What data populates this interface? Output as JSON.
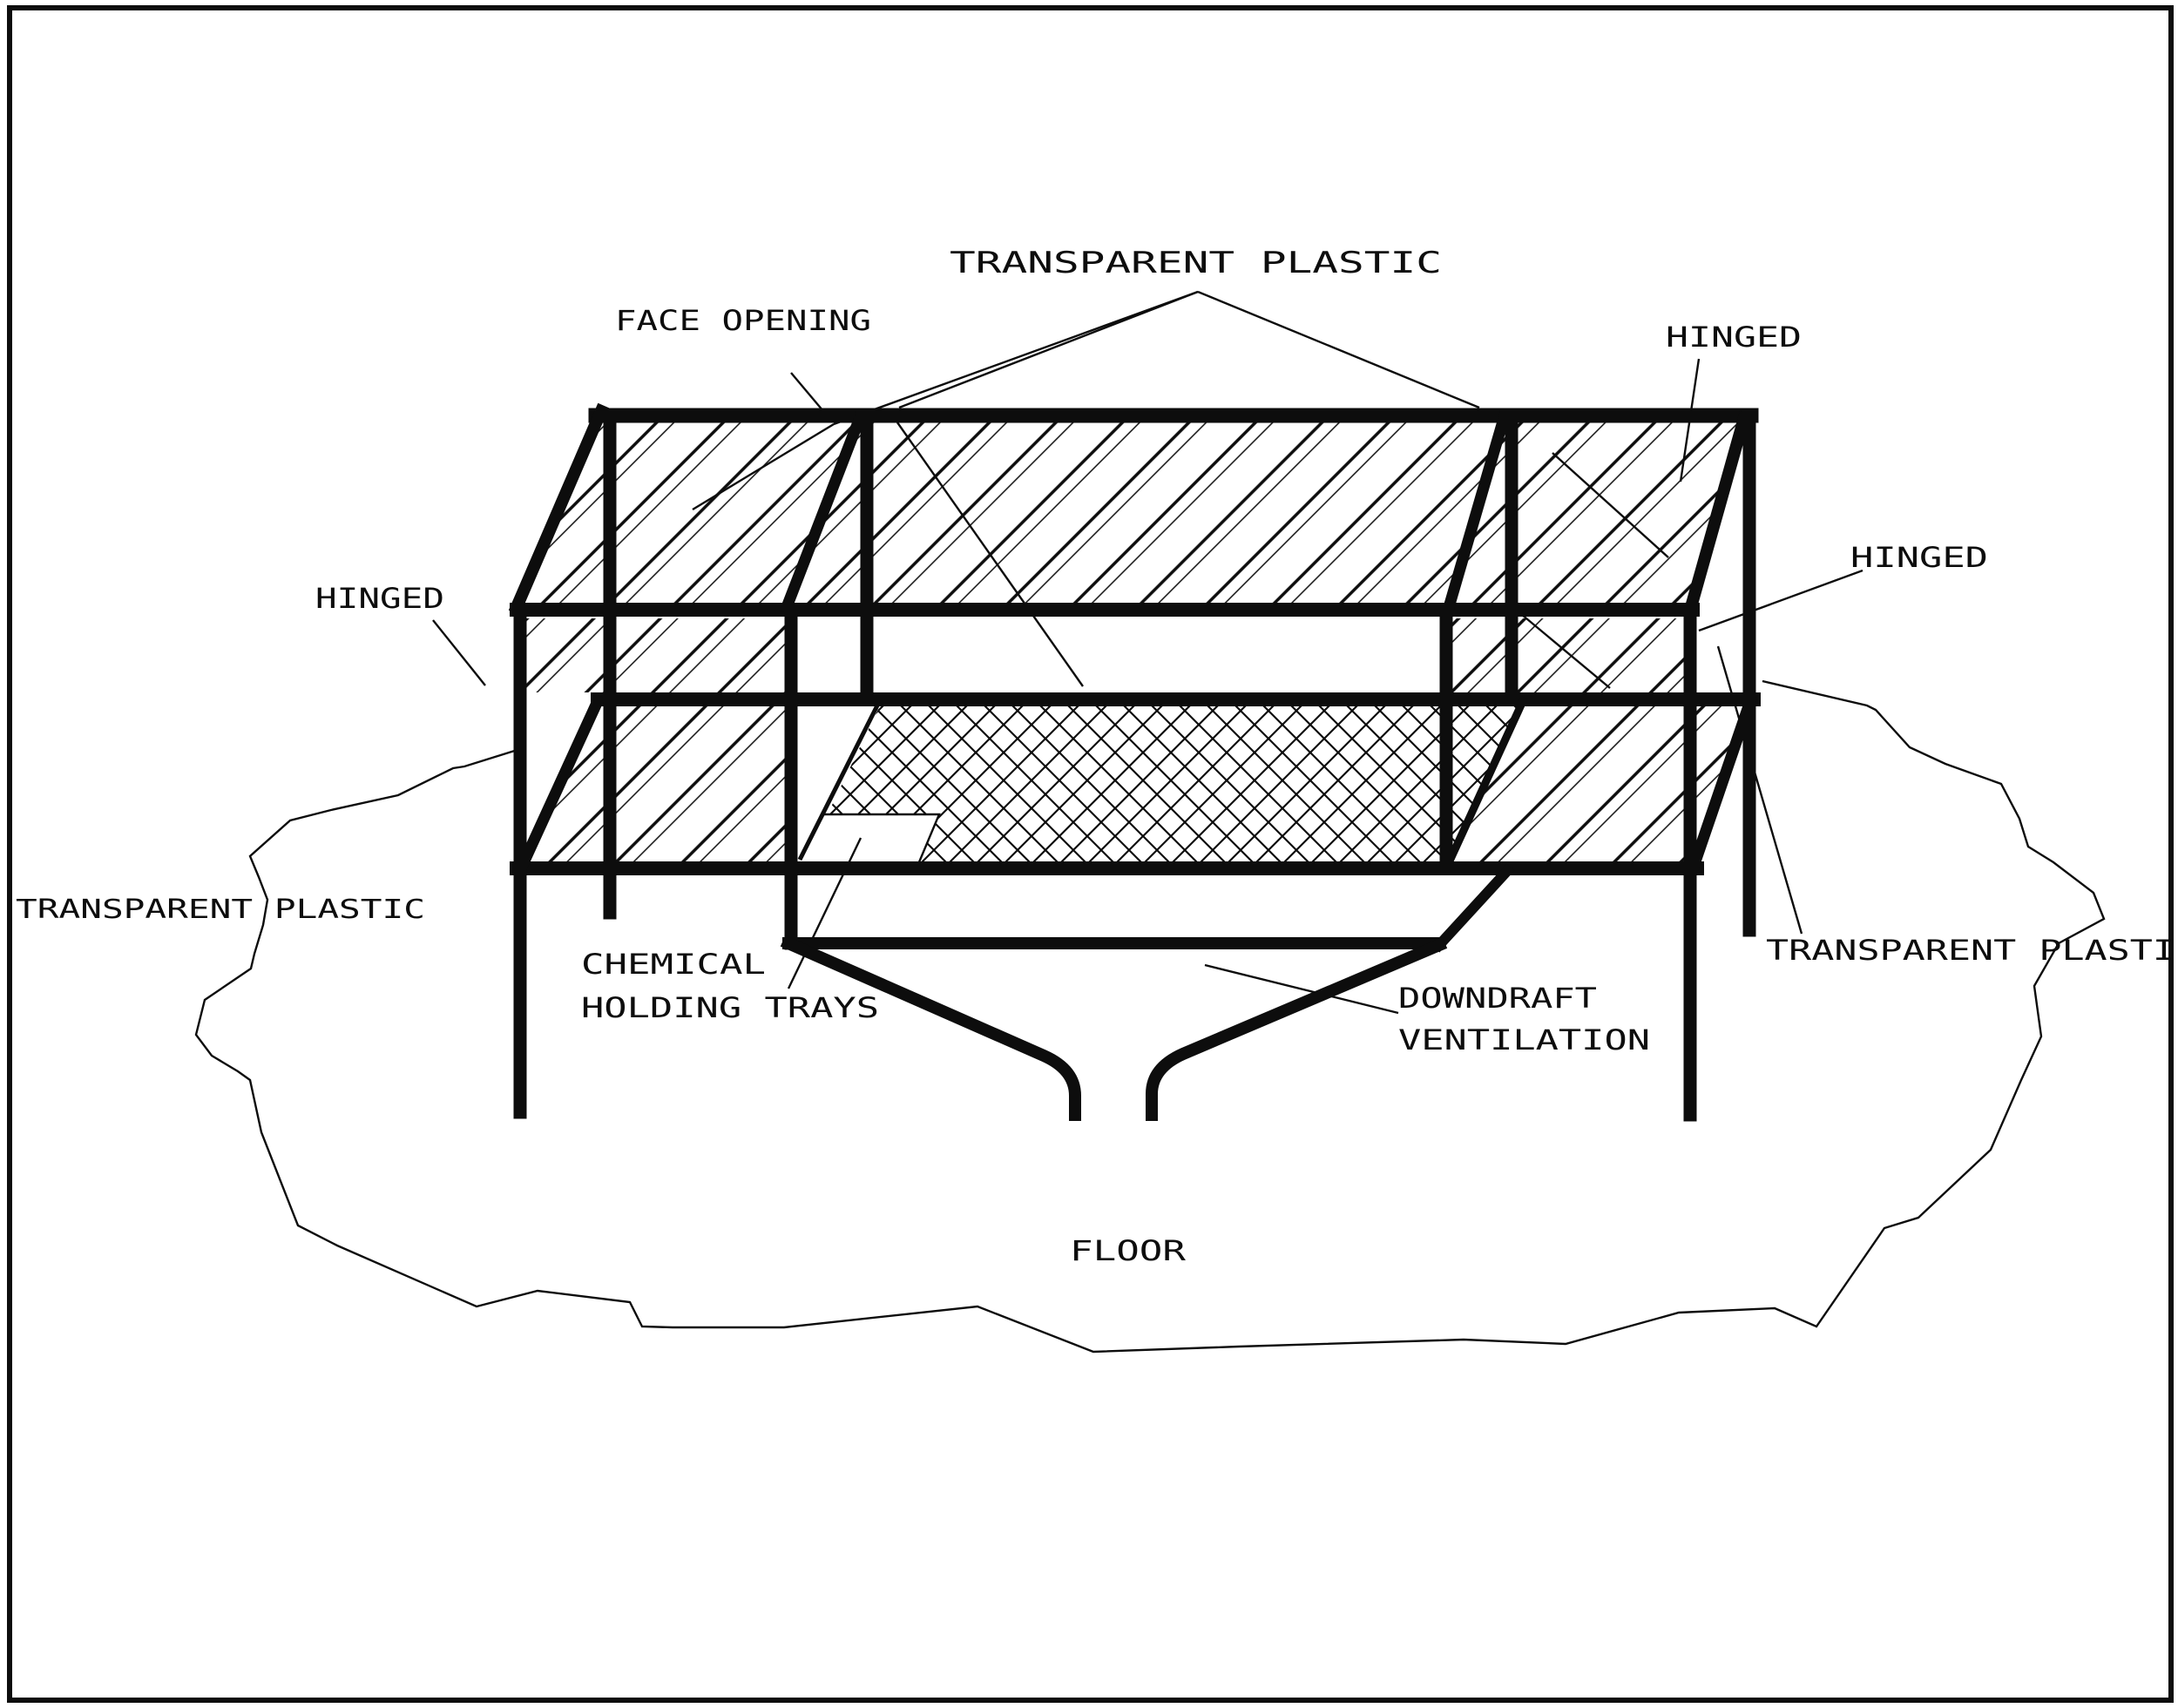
{
  "page": {
    "background": "#ffffff",
    "ink": "#000000",
    "kind": "black-and-white technical line drawing of a downdraft ventilation enclosure"
  },
  "diagram": {
    "labels": {
      "transparent_plastic_top": "TRANSPARENT PLASTIC",
      "face_opening": "FACE OPENING",
      "hinged_top_right": "HINGED",
      "hinged_right": "HINGED",
      "hinged_left": "HINGED",
      "transparent_plastic_left": "TRANSPARENT PLASTIC",
      "chemical_trays_line1": "CHEMICAL",
      "chemical_trays_line2": "HOLDING TRAYS",
      "downdraft_line1": "DOWNDRAFT",
      "downdraft_line2": "VENTILATION",
      "transparent_plastic_right": "TRANSPARENT PLASTI",
      "floor": "FLOOR"
    }
  }
}
